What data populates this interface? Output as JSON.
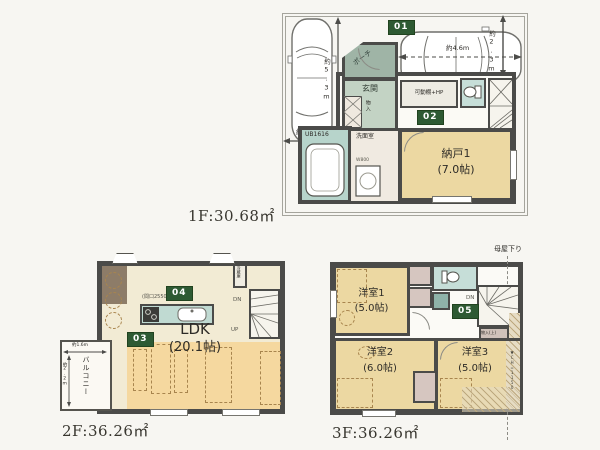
{
  "floor1": {
    "area_label": "1F:30.68㎡",
    "badge_01": "01",
    "badge_02": "02",
    "porch": "ポーチ",
    "entrance": "玄関",
    "cabinet": "物入",
    "shelf": "可動棚+HP",
    "bath": "UB1616",
    "washroom": "洗面室",
    "washer_width": "W800",
    "storage_name": "納戸1",
    "storage_size": "(7.0帖)",
    "dim_parking_left_width": "約2.6m",
    "dim_parking_left_length": "約5.3m",
    "dim_parking_right_length": "約4.6m",
    "dim_parking_right_width": "約2.3m"
  },
  "floor2": {
    "area_label": "2F:36.26㎡",
    "badge_03": "03",
    "badge_04": "04",
    "ldk_name": "LDK",
    "ldk_size": "(20.1帖)",
    "kitchen_width": "(間口2550)",
    "fridge": "冷蔵庫",
    "balcony": "バルコニー",
    "balcony_width": "約1.6m",
    "balcony_depth": "約2.2m",
    "stairs_down": "DN",
    "stairs_up": "UP"
  },
  "floor3": {
    "area_label": "3F:36.26㎡",
    "badge_05": "05",
    "room1_name": "洋室1",
    "room1_size": "(5.0帖)",
    "room2_name": "洋室2",
    "room2_size": "(6.0帖)",
    "room3_name": "洋室3",
    "room3_size": "(5.0帖)",
    "closet": "物入(上)",
    "stairs_down": "DN",
    "roof_note": "母屋下り",
    "ceiling_note": "▼CH=1150"
  }
}
